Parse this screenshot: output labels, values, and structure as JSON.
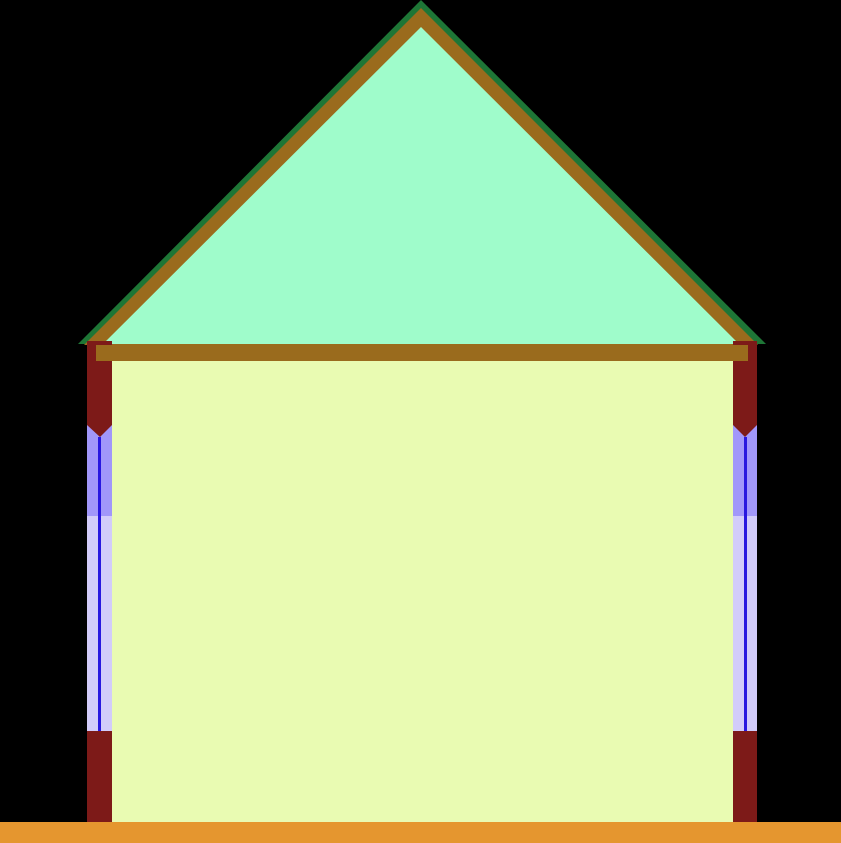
{
  "scene": {
    "description": "Cross-section diagram of a house: triangular attic under a pitched roof, rectangular interior room, side walls with tall window/frame channels, on a ground strip",
    "background_color": "#000000",
    "colors": {
      "roof_outline_green": "#1e7636",
      "roof_wood_brown": "#9a6b1d",
      "attic_mint": "#9ffccb",
      "interior_yellow": "#e9fbb2",
      "wall_maroon": "#7d1a18",
      "window_upper_purple": "#a197fa",
      "window_lower_lavender": "#d2ccfa",
      "window_mullion_blue": "#2817e0",
      "ground_orange": "#e5962f"
    }
  }
}
